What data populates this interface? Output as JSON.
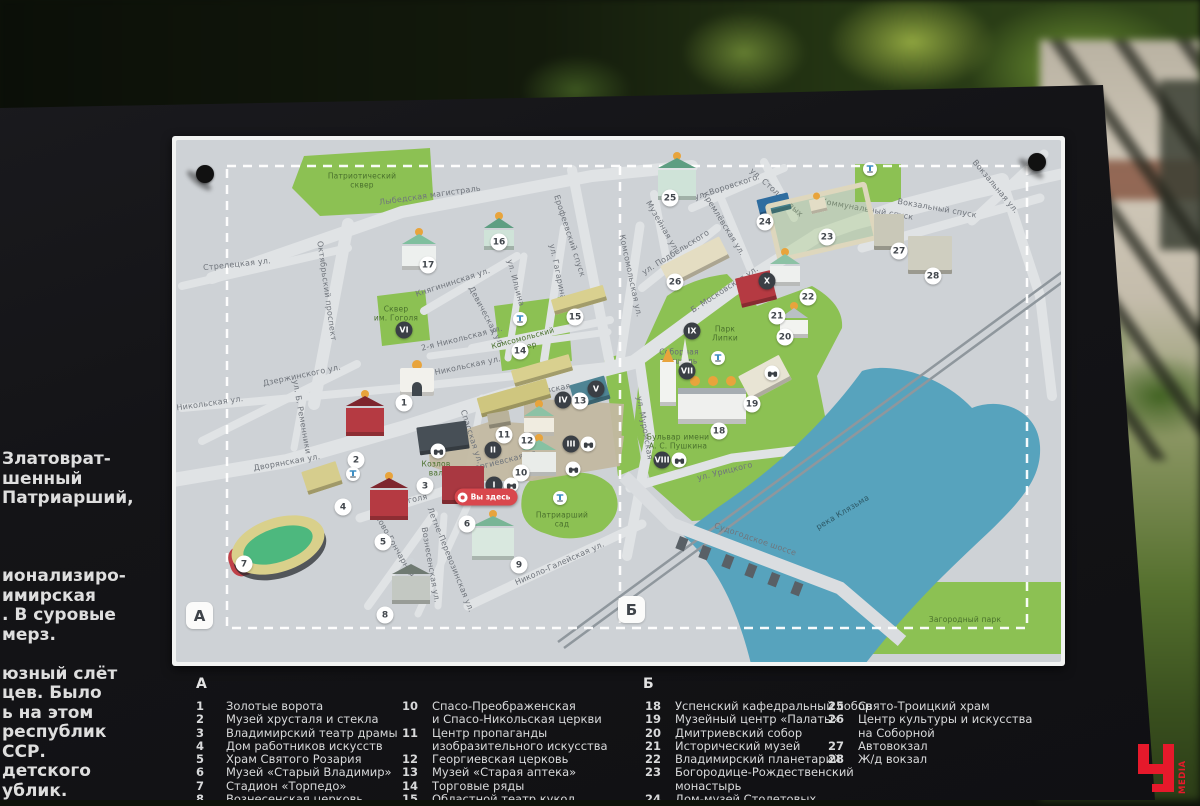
{
  "scene": {
    "description": "Outdoor information board with tourist map of Vladimir city center"
  },
  "side_text": {
    "lines": [
      "Златоврат-",
      "шенный",
      "Патриарший,",
      "",
      "",
      "",
      "ионализиро-",
      "имирская",
      ". В суровые",
      "мерз.",
      "",
      "юзный слёт",
      "цев. Было",
      "ь на этом",
      "республик",
      "ССР.",
      "детского",
      "ублик."
    ]
  },
  "logo": {
    "letter": "Ч",
    "word": "MEDIA",
    "color": "#e6192b"
  },
  "map": {
    "corner_labels": [
      {
        "t": "А",
        "x": 14,
        "y": 466
      },
      {
        "t": "Б",
        "x": 446,
        "y": 460
      }
    ],
    "you_are_here": "Вы здесь",
    "pins": [
      {
        "x": 33,
        "y": 38
      },
      {
        "x": 865,
        "y": 26
      }
    ],
    "labels": [
      {
        "t": "Лыбедская магистраль",
        "x": 258,
        "y": 60,
        "r": -8
      },
      {
        "t": "Стрелецкая ул.",
        "x": 65,
        "y": 129,
        "r": -6
      },
      {
        "t": "Октябрьский проспект",
        "x": 154,
        "y": 155,
        "r": 82
      },
      {
        "t": "Княгининская ул.",
        "x": 281,
        "y": 147,
        "r": -18
      },
      {
        "t": "Ерофеевский спуск",
        "x": 397,
        "y": 100,
        "r": 72
      },
      {
        "t": "ул. Гагарина",
        "x": 385,
        "y": 136,
        "r": 78
      },
      {
        "t": "ул. Ильина",
        "x": 343,
        "y": 147,
        "r": 75
      },
      {
        "t": "Девическая ул.",
        "x": 314,
        "y": 181,
        "r": 62
      },
      {
        "t": "2-я Никольская ул.",
        "x": 290,
        "y": 203,
        "r": -14
      },
      {
        "t": "1-я Никольская ул.",
        "x": 288,
        "y": 232,
        "r": -12
      },
      {
        "t": "Никольская ул.",
        "x": 38,
        "y": 268,
        "r": -8
      },
      {
        "t": "Дзержинского ул.",
        "x": 130,
        "y": 240,
        "r": -12
      },
      {
        "t": "ул. Б. Ременники",
        "x": 129,
        "y": 281,
        "r": 80
      },
      {
        "t": "Дворянская ул.",
        "x": 115,
        "y": 327,
        "r": -10
      },
      {
        "t": "ул. Гоголя",
        "x": 233,
        "y": 366,
        "r": -12
      },
      {
        "t": "ул. Б. Московская",
        "x": 360,
        "y": 258,
        "r": -11
      },
      {
        "t": "Спасская ул.",
        "x": 299,
        "y": 301,
        "r": 72
      },
      {
        "t": "Георгиевская ул.",
        "x": 330,
        "y": 326,
        "r": -14
      },
      {
        "t": "Ново-Гончарная ул.",
        "x": 226,
        "y": 417,
        "r": 60
      },
      {
        "t": "Вознесенская ул.",
        "x": 258,
        "y": 429,
        "r": 80
      },
      {
        "t": "Летне-Перевозинская ул.",
        "x": 278,
        "y": 424,
        "r": 68
      },
      {
        "t": "Николо-Галейская ул.",
        "x": 388,
        "y": 428,
        "r": -24
      },
      {
        "t": "ул. Муромская",
        "x": 472,
        "y": 292,
        "r": 80
      },
      {
        "t": "ул. Урицкого",
        "x": 553,
        "y": 336,
        "r": -14
      },
      {
        "t": "Комсомольская ул.",
        "x": 458,
        "y": 140,
        "r": 78
      },
      {
        "t": "ул. Подбельского",
        "x": 504,
        "y": 117,
        "r": -32
      },
      {
        "t": "Музейная ул.",
        "x": 490,
        "y": 91,
        "r": 60
      },
      {
        "t": "ул. Воровского",
        "x": 554,
        "y": 52,
        "r": -18
      },
      {
        "t": "ул. Столетовых",
        "x": 604,
        "y": 57,
        "r": 42
      },
      {
        "t": "Кремлёвская ул.",
        "x": 551,
        "y": 88,
        "r": 58
      },
      {
        "t": "Коммунальный спуск",
        "x": 695,
        "y": 74,
        "r": 10
      },
      {
        "t": "Б. Московская ул.",
        "x": 553,
        "y": 154,
        "r": -33
      },
      {
        "t": "Вокзальный спуск",
        "x": 765,
        "y": 73,
        "r": 10
      },
      {
        "t": "Вокзальная ул.",
        "x": 823,
        "y": 51,
        "r": 50
      },
      {
        "t": "Судогодское шоссе",
        "x": 583,
        "y": 404,
        "r": 19
      },
      {
        "t": "Патриотический\nсквер",
        "x": 190,
        "y": 45,
        "cls": "park"
      },
      {
        "t": "Сквер\nим. Гоголя",
        "x": 224,
        "y": 178,
        "cls": "park"
      },
      {
        "t": "Комсомольский\nсквер",
        "x": 352,
        "y": 207,
        "r": -15,
        "cls": "park"
      },
      {
        "t": "Козлов\nвал",
        "x": 264,
        "y": 333,
        "cls": "park"
      },
      {
        "t": "Патриарший\nсад",
        "x": 390,
        "y": 384,
        "cls": "park"
      },
      {
        "t": "Парк\nЛипки",
        "x": 553,
        "y": 198,
        "cls": "park"
      },
      {
        "t": "Бульвар имени\nА. С. Пушкина",
        "x": 506,
        "y": 306,
        "cls": "park"
      },
      {
        "t": "Загородный парк",
        "x": 793,
        "y": 484,
        "cls": "park"
      },
      {
        "t": "Соборная\nплощадь",
        "x": 507,
        "y": 221,
        "cls": "plaza"
      },
      {
        "t": "река Клязьма",
        "x": 671,
        "y": 377,
        "r": -31,
        "cls": "water"
      }
    ],
    "markers": [
      {
        "n": "1",
        "x": 232,
        "y": 267
      },
      {
        "n": "2",
        "x": 184,
        "y": 324
      },
      {
        "n": "3",
        "x": 253,
        "y": 350
      },
      {
        "n": "4",
        "x": 171,
        "y": 371
      },
      {
        "n": "5",
        "x": 211,
        "y": 406
      },
      {
        "n": "6",
        "x": 295,
        "y": 388
      },
      {
        "n": "7",
        "x": 72,
        "y": 428
      },
      {
        "n": "8",
        "x": 213,
        "y": 479
      },
      {
        "n": "9",
        "x": 347,
        "y": 429
      },
      {
        "n": "10",
        "x": 349,
        "y": 337
      },
      {
        "n": "11",
        "x": 332,
        "y": 299
      },
      {
        "n": "12",
        "x": 355,
        "y": 305
      },
      {
        "n": "13",
        "x": 408,
        "y": 265
      },
      {
        "n": "14",
        "x": 348,
        "y": 215
      },
      {
        "n": "15",
        "x": 403,
        "y": 181
      },
      {
        "n": "16",
        "x": 327,
        "y": 106
      },
      {
        "n": "17",
        "x": 256,
        "y": 129
      },
      {
        "n": "18",
        "x": 547,
        "y": 295
      },
      {
        "n": "19",
        "x": 580,
        "y": 268
      },
      {
        "n": "20",
        "x": 613,
        "y": 201
      },
      {
        "n": "21",
        "x": 605,
        "y": 180
      },
      {
        "n": "22",
        "x": 636,
        "y": 161
      },
      {
        "n": "23",
        "x": 655,
        "y": 101
      },
      {
        "n": "24",
        "x": 593,
        "y": 86
      },
      {
        "n": "25",
        "x": 498,
        "y": 62
      },
      {
        "n": "26",
        "x": 503,
        "y": 146
      },
      {
        "n": "27",
        "x": 727,
        "y": 115
      },
      {
        "n": "28",
        "x": 761,
        "y": 140
      }
    ],
    "roman": [
      {
        "t": "I",
        "x": 322,
        "y": 349
      },
      {
        "t": "II",
        "x": 321,
        "y": 314
      },
      {
        "t": "III",
        "x": 399,
        "y": 308
      },
      {
        "t": "IV",
        "x": 391,
        "y": 264
      },
      {
        "t": "V",
        "x": 424,
        "y": 253
      },
      {
        "t": "VI",
        "x": 232,
        "y": 194
      },
      {
        "t": "VII",
        "x": 515,
        "y": 235
      },
      {
        "t": "VIII",
        "x": 490,
        "y": 324
      },
      {
        "t": "IX",
        "x": 520,
        "y": 195
      },
      {
        "t": "X",
        "x": 595,
        "y": 145
      }
    ],
    "viewpoints": [
      {
        "x": 339,
        "y": 349
      },
      {
        "x": 416,
        "y": 308
      },
      {
        "x": 401,
        "y": 333
      },
      {
        "x": 507,
        "y": 324
      },
      {
        "x": 600,
        "y": 237
      },
      {
        "x": 266,
        "y": 315
      }
    ],
    "fountains": [
      {
        "x": 348,
        "y": 183
      },
      {
        "x": 181,
        "y": 338
      },
      {
        "x": 388,
        "y": 362
      },
      {
        "x": 546,
        "y": 222
      },
      {
        "x": 698,
        "y": 33
      }
    ],
    "buildings": [
      {
        "t": "church",
        "n": "church-17",
        "x": 230,
        "y": 92,
        "w": 34,
        "h": 42,
        "c": "#edf0ee",
        "rc": "#7fbf9e",
        "dc": "#e8a43c"
      },
      {
        "t": "church",
        "n": "church-16",
        "x": 312,
        "y": 76,
        "w": 30,
        "h": 38,
        "c": "#cfe3d8",
        "rc": "#5e9e82",
        "dc": "#e8a43c"
      },
      {
        "t": "block",
        "n": "trade-rows-upper",
        "x": 380,
        "y": 156,
        "w": 54,
        "h": 16,
        "c": "#d9d08f",
        "r": -16
      },
      {
        "t": "block",
        "n": "trade-rows-mid",
        "x": 340,
        "y": 226,
        "w": 60,
        "h": 17,
        "c": "#d9d08f",
        "r": -16
      },
      {
        "t": "block",
        "n": "trade-rows-lower",
        "x": 306,
        "y": 252,
        "w": 72,
        "h": 20,
        "c": "#cfc67f",
        "r": -16
      },
      {
        "t": "block",
        "n": "old-pharmacy-13",
        "x": 400,
        "y": 244,
        "w": 36,
        "h": 24,
        "c": "#4e8494",
        "r": -16
      },
      {
        "t": "church",
        "n": "church-12",
        "x": 352,
        "y": 264,
        "w": 30,
        "h": 36,
        "c": "#f0ece0",
        "rc": "#8cc2a5",
        "dc": "#e8a43c"
      },
      {
        "t": "church",
        "n": "church-10",
        "x": 350,
        "y": 298,
        "w": 34,
        "h": 42,
        "c": "#e9ece9",
        "rc": "#86c1a2",
        "dc": "#e8a43c"
      },
      {
        "t": "block",
        "n": "building-11",
        "x": 316,
        "y": 276,
        "w": 22,
        "h": 15,
        "c": "#b9b29a",
        "r": -10
      },
      {
        "t": "gate",
        "n": "golden-gate-1",
        "x": 228,
        "y": 228,
        "w": 34,
        "h": 32
      },
      {
        "t": "church",
        "n": "crystal-museum-2",
        "x": 174,
        "y": 254,
        "w": 38,
        "h": 46,
        "c": "#b53a42",
        "rc": "#7e262e",
        "dc": "#e8a43c"
      },
      {
        "t": "block",
        "n": "drama-theatre-3",
        "x": 246,
        "y": 288,
        "w": 50,
        "h": 28,
        "c": "#474f56",
        "r": -8
      },
      {
        "t": "block",
        "n": "building-4",
        "x": 132,
        "y": 330,
        "w": 36,
        "h": 24,
        "c": "#d6cd8d",
        "r": -18
      },
      {
        "t": "church",
        "n": "rosary-church-5",
        "x": 198,
        "y": 336,
        "w": 38,
        "h": 48,
        "c": "#b53a42",
        "rc": "#7e262e",
        "dc": "#e8a43c"
      },
      {
        "t": "block",
        "n": "old-vladimir-6",
        "x": 270,
        "y": 330,
        "w": 42,
        "h": 38,
        "c": "#a93841",
        "r": 0
      },
      {
        "t": "stadium",
        "n": "stadium-torpedo-7",
        "x": 58,
        "y": 382,
        "w": 96,
        "h": 54
      },
      {
        "t": "church",
        "n": "church-8",
        "x": 220,
        "y": 422,
        "w": 38,
        "h": 46,
        "c": "#c3c8c2",
        "rc": "#6f7a72",
        "dc": "#cfd4d8"
      },
      {
        "t": "church",
        "n": "church-9",
        "x": 300,
        "y": 374,
        "w": 42,
        "h": 50,
        "c": "#d9e8df",
        "rc": "#79b596",
        "dc": "#e8a43c"
      },
      {
        "t": "church",
        "n": "trinity-25",
        "x": 486,
        "y": 16,
        "w": 38,
        "h": 48,
        "c": "#cfe3d8",
        "rc": "#5e9e82",
        "dc": "#e8a43c"
      },
      {
        "t": "block",
        "n": "stoletov-house-24",
        "x": 586,
        "y": 60,
        "w": 32,
        "h": 17,
        "c": "#2f6da0",
        "r": -14
      },
      {
        "t": "monastery",
        "n": "nativity-monastery-23",
        "x": 598,
        "y": 56,
        "w": 104,
        "h": 60,
        "r": -13
      },
      {
        "t": "block",
        "n": "building-26",
        "x": 490,
        "y": 114,
        "w": 66,
        "h": 24,
        "c": "#e4ddc2",
        "r": -27
      },
      {
        "t": "block",
        "n": "history-museum-21",
        "x": 566,
        "y": 138,
        "w": 36,
        "h": 30,
        "c": "#b53a42",
        "r": -14
      },
      {
        "t": "church",
        "n": "planetarium-22",
        "x": 598,
        "y": 112,
        "w": 30,
        "h": 38,
        "c": "#eef0ee",
        "rc": "#8cc2a5",
        "dc": "#e8a43c"
      },
      {
        "t": "church",
        "n": "dmitrievsky-20",
        "x": 608,
        "y": 166,
        "w": 28,
        "h": 36,
        "c": "#f2f3f0",
        "rc": "#b9c0c5",
        "dc": "#e8a43c"
      },
      {
        "t": "cathedral",
        "n": "assumption-cathedral-18",
        "x": 492,
        "y": 236,
        "w": 84,
        "h": 52
      },
      {
        "t": "block",
        "n": "palaty-19",
        "x": 570,
        "y": 228,
        "w": 46,
        "h": 28,
        "c": "#e8e4d4",
        "r": -28
      },
      {
        "t": "block",
        "n": "bus-station-27",
        "x": 702,
        "y": 78,
        "w": 30,
        "h": 36,
        "c": "#c9c8b8",
        "r": 0
      },
      {
        "t": "block",
        "n": "rail-station-28",
        "x": 736,
        "y": 100,
        "w": 44,
        "h": 38,
        "c": "#cfcec0",
        "r": 0
      },
      {
        "t": "monument",
        "n": "obelisk",
        "x": 506,
        "y": 200,
        "w": 14,
        "h": 30
      }
    ],
    "colors": {
      "bg": "#ced2d6",
      "road": "#e0e3e5",
      "green": "#8cc153",
      "water": "#57a3bd",
      "tan": "#c3b9a2",
      "rail": "#8f979d",
      "dash": "#ffffff"
    }
  },
  "legend": {
    "sections": [
      {
        "header": "А",
        "header_x": 196,
        "header_y": 676,
        "columns": [
          {
            "x": 196,
            "y": 700,
            "items": [
              {
                "n": "1",
                "t": "Золотые ворота"
              },
              {
                "n": "2",
                "t": "Музей хрусталя и стекла"
              },
              {
                "n": "3",
                "t": "Владимирский театр драмы"
              },
              {
                "n": "4",
                "t": "Дом работников искусств"
              },
              {
                "n": "5",
                "t": "Храм Святого Розария"
              },
              {
                "n": "6",
                "t": "Музей «Старый Владимир»"
              },
              {
                "n": "7",
                "t": "Стадион «Торпедо»"
              },
              {
                "n": "8",
                "t": "Вознесенская церковь"
              }
            ]
          },
          {
            "x": 402,
            "y": 700,
            "items": [
              {
                "n": "10",
                "t": "Спасо-Преображенская\nи Спасо-Никольская церкви"
              },
              {
                "n": "11",
                "t": "Центр пропаганды\nизобразительного искусства"
              },
              {
                "n": "12",
                "t": "Георгиевская церковь"
              },
              {
                "n": "13",
                "t": "Музей «Старая аптека»"
              },
              {
                "n": "14",
                "t": "Торговые ряды"
              },
              {
                "n": "15",
                "t": "Областной театр кукол"
              }
            ]
          }
        ]
      },
      {
        "header": "Б",
        "header_x": 643,
        "header_y": 676,
        "columns": [
          {
            "x": 645,
            "y": 700,
            "items": [
              {
                "n": "18",
                "t": "Успенский кафедральный собор"
              },
              {
                "n": "19",
                "t": "Музейный центр «Палаты»"
              },
              {
                "n": "20",
                "t": "Дмитриевский собор"
              },
              {
                "n": "21",
                "t": "Исторический музей"
              },
              {
                "n": "22",
                "t": "Владимирский планетарий"
              },
              {
                "n": "23",
                "t": "Богородице-Рождественский\nмонастырь"
              },
              {
                "n": "24",
                "t": "Дом-музей Столетовых"
              }
            ]
          },
          {
            "x": 828,
            "y": 700,
            "items": [
              {
                "n": "25",
                "t": "Свято-Троицкий храм"
              },
              {
                "n": "26",
                "t": "Центр культуры и искусства\nна Соборной"
              },
              {
                "n": "27",
                "t": "Автовокзал"
              },
              {
                "n": "28",
                "t": "Ж/д вокзал"
              }
            ]
          }
        ]
      }
    ]
  }
}
